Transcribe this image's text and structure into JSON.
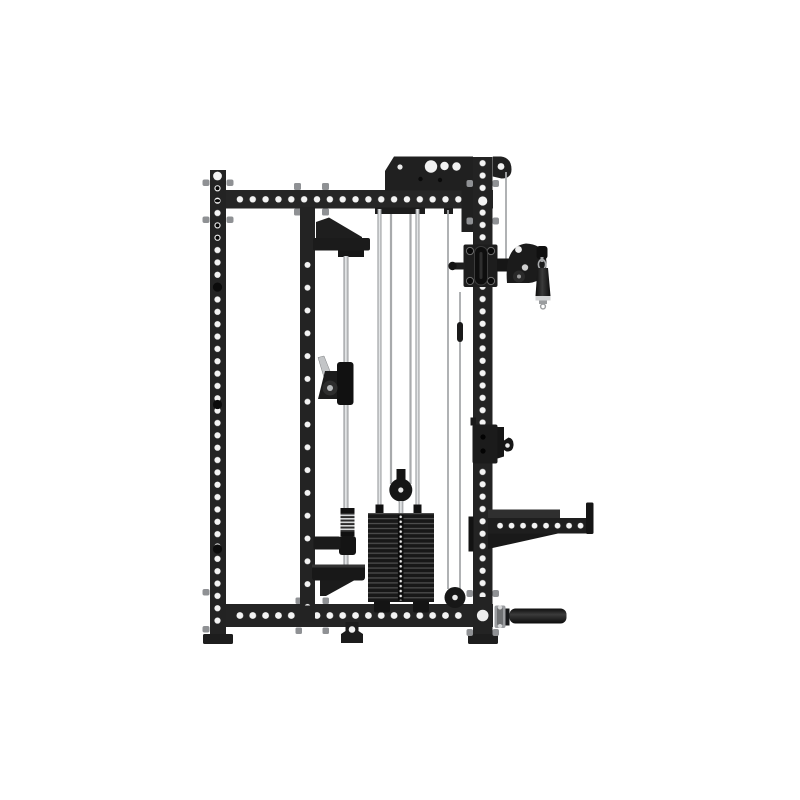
{
  "image": {
    "subject": "Matte black half power rack with selectorized weight stack, cable pulley system, adjustable swivel pulley with hanging grip, J-hook, hole-punched spotter arm and landmine handle - side profile studio product photo on white background",
    "background_color": "#ffffff",
    "style": "flat studio product render, side view, no text or watermark"
  },
  "palette": {
    "frame_black": "#232323",
    "bracket_black": "#1d1d1d",
    "attachment_black": "#161616",
    "hole_white": "#f3f3f3",
    "hole_dark": "#050505",
    "metal_silver": "#b9bcbe",
    "rod_highlight": "#eef0f1",
    "cable_gray": "#a8aaac",
    "spring_stripe": "#d5d7d8",
    "grip_end_gray": "#d2d3d4",
    "bolt_gray": "#8f9194"
  },
  "equipment": {
    "name": "half rack with functional trainer cable system",
    "finish": "matte black powder-coated steel",
    "parts": [
      "left upright with bolt-hole column",
      "inner upright",
      "right upright with bolt-hole column",
      "top crossmember with hole row",
      "bottom base beam with hole row",
      "top gusset plate with corner cable pulley",
      "lat pulldown guide rod and carriage",
      "buffer spring and carriage stop shelf",
      "selectorized weight stack with top pulley and guide rods",
      "floor-level cable pulley",
      "adjustable swivel pulley trolley with pop-pin",
      "hanging single-grip cable handle with carabiner",
      "J-hook bar catch",
      "spotter arm with numbered hole row",
      "landmine / barbell handle sleeve",
      "foot plates"
    ],
    "weight_stack": {
      "plates": 18,
      "selector_pin_holes": 18
    },
    "counts": {
      "top_beam_holes": 18,
      "bottom_beam_holes": 18,
      "spotter_arm_holes": 8,
      "trolley_corner_bolts": 4
    }
  }
}
